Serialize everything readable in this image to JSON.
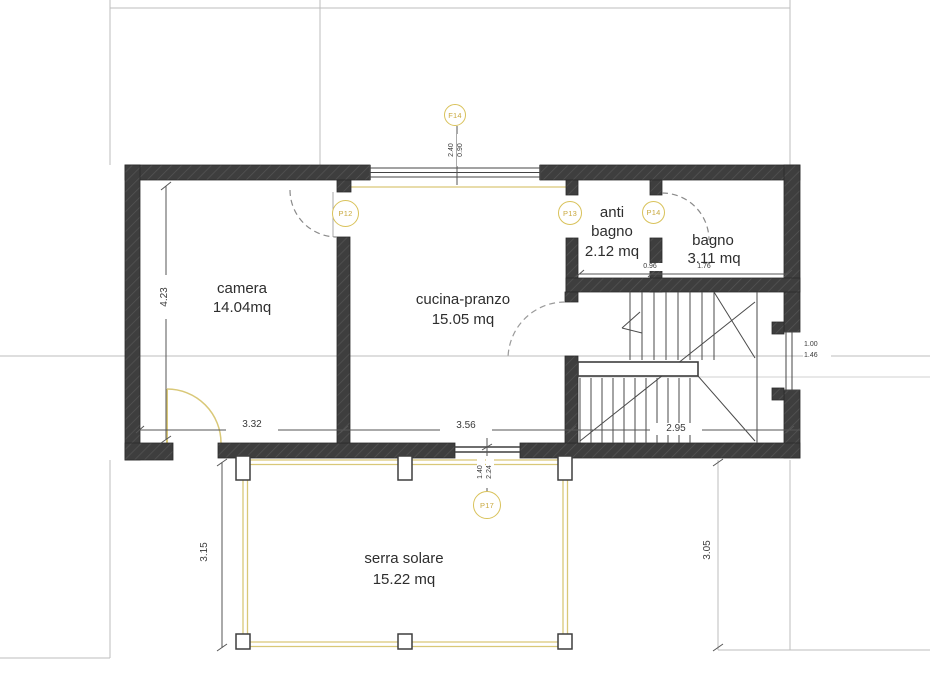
{
  "rooms": {
    "camera": {
      "name": "camera",
      "area": "14.04mq"
    },
    "cucina": {
      "name": "cucina-pranzo",
      "area": "15.05 mq"
    },
    "antibagno": {
      "name": "anti bagno",
      "area": "2.12 mq"
    },
    "bagno": {
      "name": "bagno",
      "area": "3.11 mq"
    },
    "serra": {
      "name": "serra solare",
      "area": "15.22 mq"
    }
  },
  "markers": {
    "window_top": "F14",
    "door_camera": "P12",
    "door_antibagno": "P13",
    "door_bagno": "P14",
    "door_serra": "P17"
  },
  "dimensions": {
    "camera_height": "4.23",
    "camera_width": "3.32",
    "cucina_width": "3.56",
    "stair_width": "2.95",
    "antibagno_width": "0.96",
    "bagno_width": "1.76",
    "serra_left": "3.15",
    "serra_right": "3.05",
    "level_a": "1.00",
    "level_b": "1.46",
    "window_w": "2.40",
    "window_h": "0.90",
    "serra_door_w": "1.40",
    "serra_door_h": "2.24"
  },
  "colors": {
    "wall": "#3e3e3e",
    "accent_yellow": "#d9c878",
    "marker_ring": "#d9c25a",
    "reference_line": "#bdbdbd"
  }
}
